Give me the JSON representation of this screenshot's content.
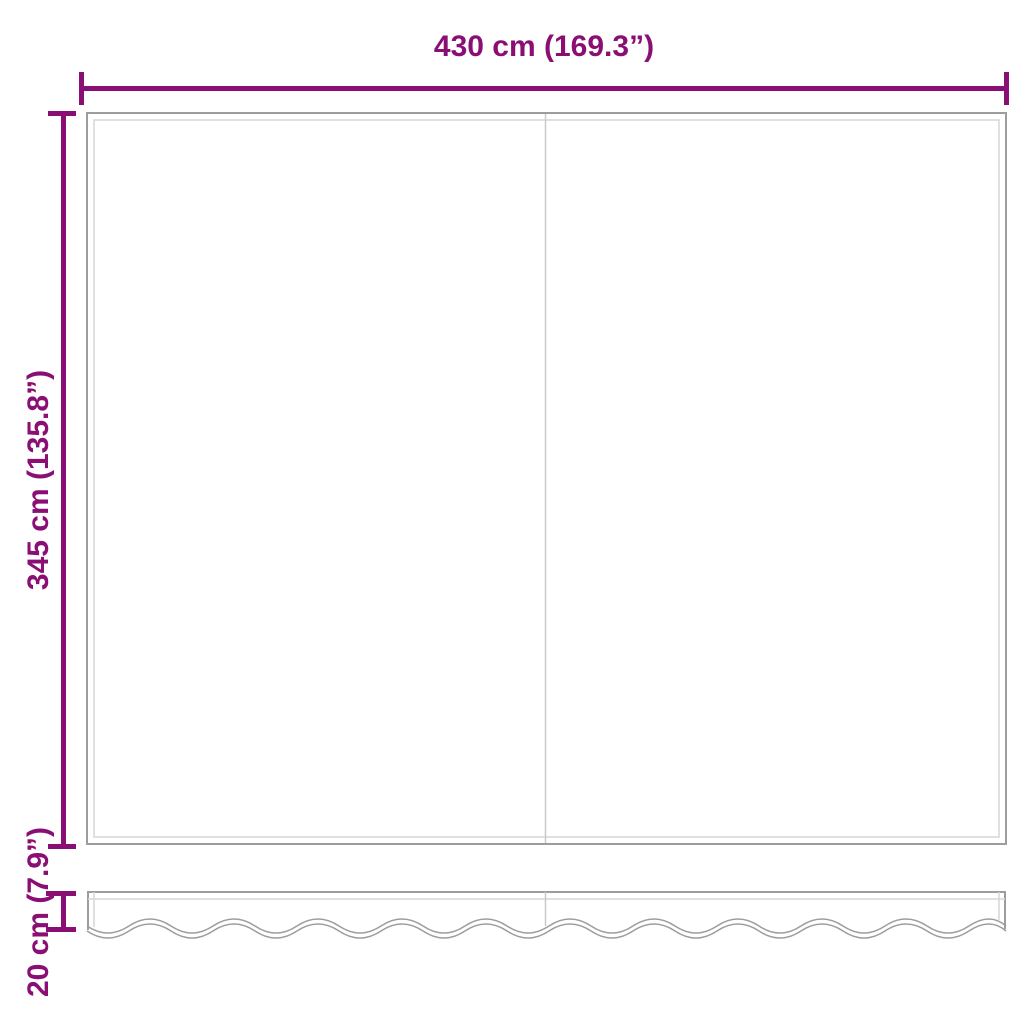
{
  "dimensions": {
    "width": {
      "label": "430 cm (169.3”)"
    },
    "height": {
      "label": "345 cm (135.8”)"
    },
    "valance_height": {
      "label": "20 cm (7.9”)"
    }
  },
  "colors": {
    "dimension_lines": "#8a0f74",
    "fabric_outline": "#9d9d9d",
    "hem_lines": "#d6d6d6",
    "seam_lines": "#c9c9c9",
    "background": "#ffffff"
  }
}
